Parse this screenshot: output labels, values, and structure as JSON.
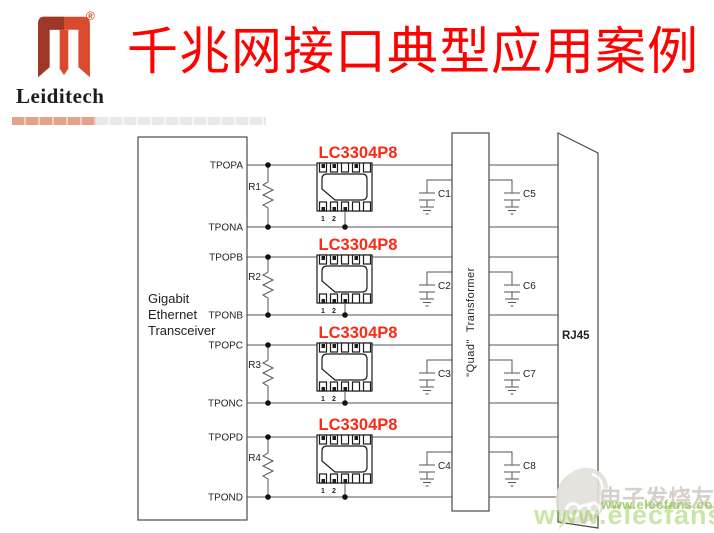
{
  "header": {
    "brand": "Leiditech",
    "registered": "®",
    "title": "千兆网接口典型应用案例"
  },
  "diagram": {
    "transceiver": {
      "line1": "Gigabit",
      "line2": "Ethernet",
      "line3": "Transceiver"
    },
    "pins": [
      "TPOPA",
      "TPONA",
      "TPOPB",
      "TPONB",
      "TPOPC",
      "TPONC",
      "TPOPD",
      "TPOND"
    ],
    "channels": [
      {
        "resistor": "R1",
        "ic": "LC3304P8",
        "cap_left": "C1",
        "cap_right": "C5"
      },
      {
        "resistor": "R2",
        "ic": "LC3304P8",
        "cap_left": "C2",
        "cap_right": "C6"
      },
      {
        "resistor": "R3",
        "ic": "LC3304P8",
        "cap_left": "C3",
        "cap_right": "C7"
      },
      {
        "resistor": "R4",
        "ic": "LC3304P8",
        "cap_left": "C4",
        "cap_right": "C8"
      }
    ],
    "pin1": "1",
    "pin2": "2",
    "transformer": "\"Quad\"  Transformer",
    "rj45": "RJ45"
  },
  "watermark": {
    "cn": "电子发烧友",
    "url": "www.elecfans.com",
    "url_large": "www.elecfans.com"
  },
  "colors": {
    "title_red": "#fe0202",
    "ic_label_red": "#fa2a15",
    "brand_dark": "#9e3726",
    "brand_bright": "#d84b2c",
    "bar_salmon": "#e5a28b",
    "bar_gray": "#e9e9e9",
    "watermark_green": "#8cc63f",
    "line": "#555555"
  }
}
